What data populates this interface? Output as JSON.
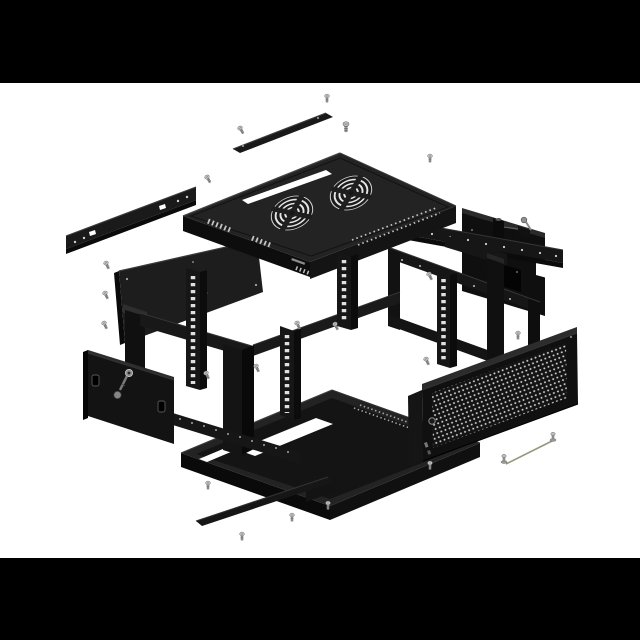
{
  "figure": {
    "type": "exploded-assembly-illustration",
    "subject": "Black wall-mount network server rack cabinet shown disassembled in an exploded isometric view on a white background with black letterbox bars",
    "visible_text": ""
  },
  "canvas": {
    "width": 640,
    "height": 640,
    "background": "#ffffff",
    "letterbox": {
      "color": "#000000",
      "top_height": 83,
      "bottom_height": 82
    }
  },
  "palette": {
    "cabinet_top_face": "#232323",
    "cabinet_front_face": "#121212",
    "cabinet_deep_shadow": "#0a0a0a",
    "edge_highlight": "#3c3c3c",
    "cutout_white": "#ffffff",
    "hardware_gray": "#c2c2c2",
    "hardware_gray_dark": "#707070",
    "ground_wire_olive": "#96967a",
    "mesh_dot": "#cdcdcd"
  },
  "parts": [
    {
      "id": "top-cover-strip",
      "label": "narrow top cover strip"
    },
    {
      "id": "wall-mount-bracket",
      "label": "slotted wall-mount bracket bar"
    },
    {
      "id": "top-panel",
      "label": "top panel with twin fan grilles and cable slot",
      "fan_grilles": 2,
      "cable_slots": 1
    },
    {
      "id": "rear-crossbar",
      "label": "rear crossbar with mounting holes"
    },
    {
      "id": "rear-wall-plate",
      "label": "rear wall plate with latch and key"
    },
    {
      "id": "rear-frame",
      "label": "rear rectangular frame ring"
    },
    {
      "id": "corner-post",
      "label": "vertical corner post with cross beam"
    },
    {
      "id": "side-panel",
      "label": "solid side panel"
    },
    {
      "id": "main-frame",
      "label": "front rectangular frame with perforated members"
    },
    {
      "id": "rack-rails",
      "label": "rack mounting rails with square hole columns",
      "count": 4
    },
    {
      "id": "front-door",
      "label": "solid front door with cam lock and hanging key"
    },
    {
      "id": "mesh-door",
      "label": "perforated mesh door with lock"
    },
    {
      "id": "bottom-tray",
      "label": "bottom pan with white cable-entry slots",
      "cable_slots": 2
    },
    {
      "id": "bottom-cover-strip",
      "label": "narrow bottom cover strip with end bracket"
    },
    {
      "id": "ground-wire",
      "label": "grounding wire with terminal screws"
    }
  ],
  "hardware": {
    "loose_screws": 20,
    "ground_wires": 1,
    "keys": 2,
    "locks": 2,
    "rack_rails": 4,
    "fans": 2
  }
}
